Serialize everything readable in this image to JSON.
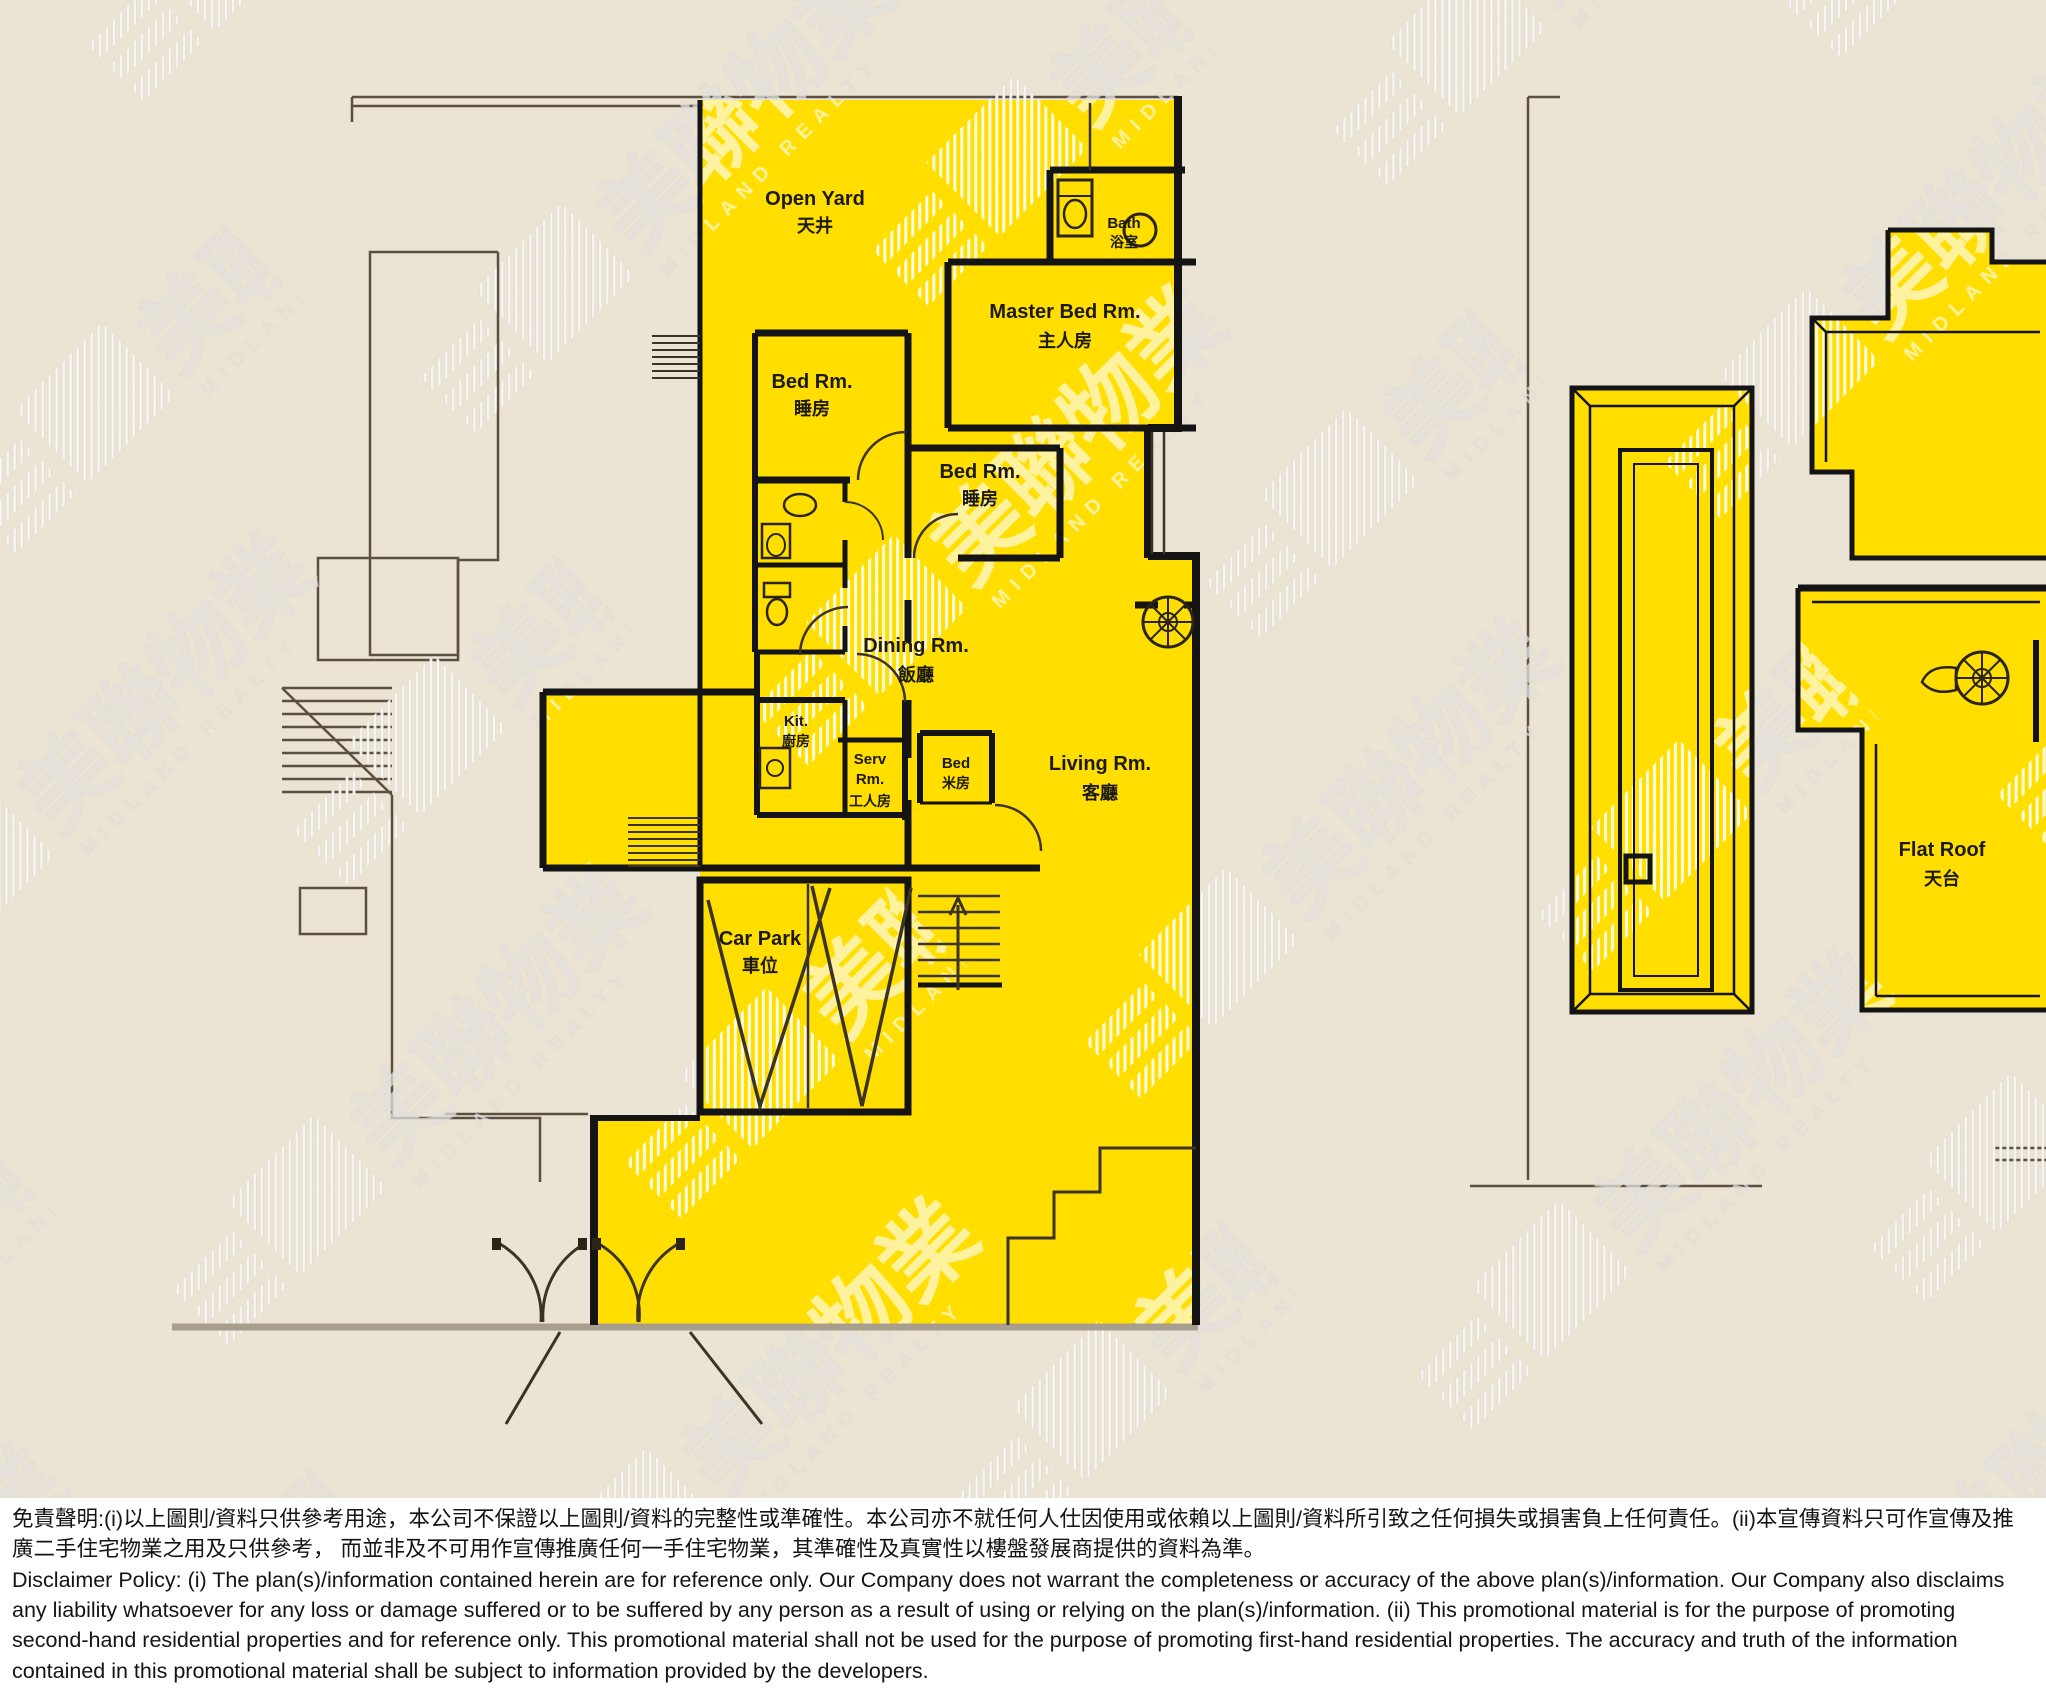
{
  "image_title": "Midland Realty residential floor plan with highlighted unit",
  "watermark": {
    "zh": "美聯物業",
    "en": "MIDLAND REALTY"
  },
  "colors": {
    "highlight_yellow": "#FFDE00",
    "plan_background": "#EBE3D3",
    "wall_black": "#141414",
    "thin_line": "#5a4f42",
    "street_line": "#A89E8E",
    "disclaimer_background": "#FFFFFF",
    "label_text": "#1c1a0e"
  },
  "floorplan": {
    "rooms": {
      "open_yard": {
        "en": "Open Yard",
        "zh": "天井"
      },
      "bath": {
        "en": "Bath",
        "zh": "浴室"
      },
      "master_bed": {
        "en": "Master Bed Rm.",
        "zh": "主人房"
      },
      "bed_1": {
        "en": "Bed Rm.",
        "zh": "睡房"
      },
      "bed_2": {
        "en": "Bed Rm.",
        "zh": "睡房"
      },
      "dining": {
        "en": "Dining Rm.",
        "zh": "飯廳"
      },
      "kitchen": {
        "en": "Kit.",
        "zh": "廚房"
      },
      "servant": {
        "en_line1": "Serv",
        "en_line2": "Rm.",
        "zh": "工人房"
      },
      "store_bed": {
        "en": "Bed",
        "zh": "米房"
      },
      "living": {
        "en": "Living Rm.",
        "zh": "客廳"
      },
      "car_park": {
        "en": "Car Park",
        "zh": "車位"
      },
      "flat_roof": {
        "en": "Flat Roof",
        "zh": "天台"
      }
    }
  },
  "disclaimer": {
    "zh": "免責聲明:(i)以上圖則/資料只供參考用途，本公司不保證以上圖則/資料的完整性或準確性。本公司亦不就任何人仕因使用或依賴以上圖則/資料所引致之任何損失或損害負上任何責任。(ii)本宣傳資料只可作宣傳及推廣二手住宅物業之用及只供參考， 而並非及不可用作宣傳推廣任何一手住宅物業，其準確性及真實性以樓盤發展商提供的資料為準。",
    "en": "Disclaimer Policy: (i) The plan(s)/information contained herein are for reference only. Our Company does not warrant the completeness or accuracy of the above plan(s)/information. Our Company also disclaims any liability whatsoever for any loss or damage suffered or to be suffered by any person as a result of using or relying on the plan(s)/information. (ii) This promotional material is for the purpose of promoting second-hand residential properties and for reference only. This promotional material shall not be used for the purpose of promoting first-hand residential properties. The accuracy and truth of the information contained in this promotional material shall be subject to information provided by the developers."
  }
}
